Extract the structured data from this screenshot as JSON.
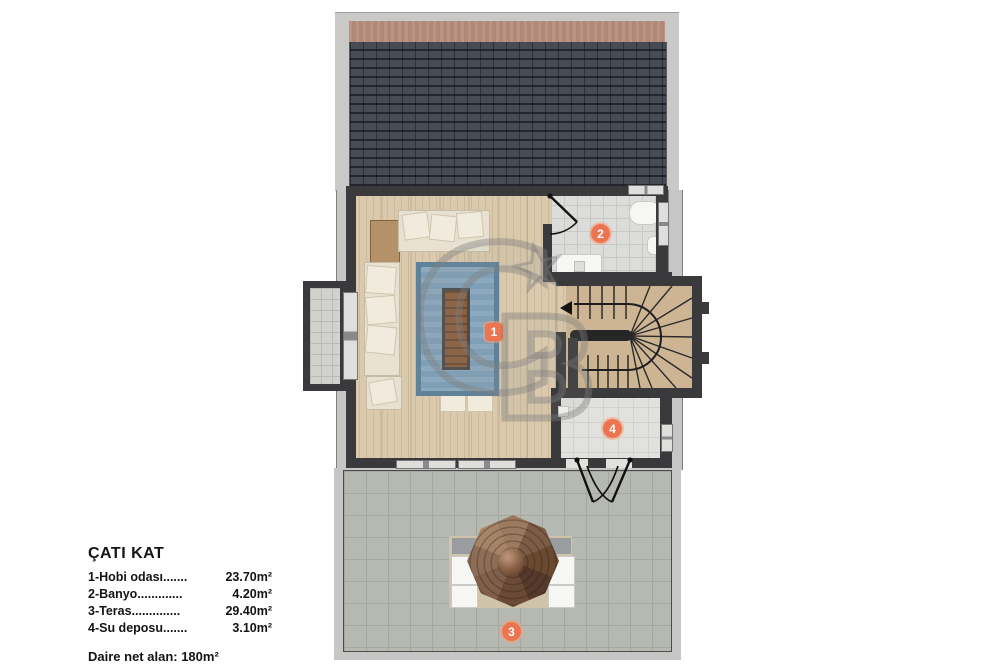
{
  "plan": {
    "markers": {
      "hobby": "1",
      "bath": "2",
      "terrace": "3",
      "depot": "4"
    }
  },
  "watermark": {
    "letter_c": "C",
    "letter_b": "B",
    "star": "★"
  },
  "legend": {
    "title": "ÇATI KAT",
    "items": [
      {
        "label": "1-Hobi odası.......",
        "area": "23.70m²"
      },
      {
        "label": "2-Banyo.............",
        "area": "4.20m²"
      },
      {
        "label": "3-Teras..............",
        "area": "29.40m²"
      },
      {
        "label": "4-Su deposu.......",
        "area": "3.10m²"
      }
    ],
    "net_area": "Daire net alan: 180m²"
  },
  "colors": {
    "marker_orange": "#ed7450",
    "roof_shingle": "#3b4046",
    "roof_ridge": "#b18877",
    "wood_floor": "#dac9ac",
    "rug_blue": "#7f9fb6",
    "terrace_tile": "#b6b9b2",
    "gazebo_brown": "#7b5a43"
  }
}
